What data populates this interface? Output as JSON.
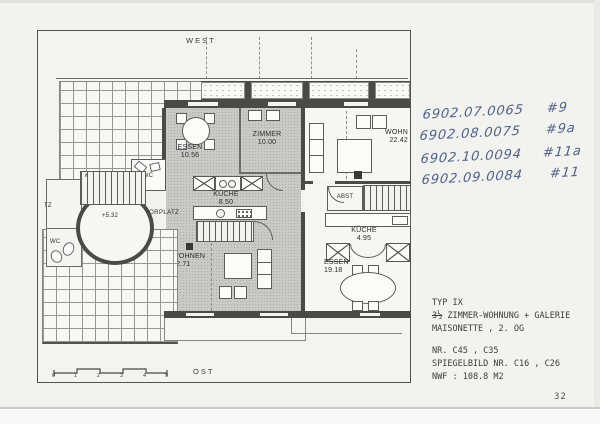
{
  "colors": {
    "paper": "#f2f2ee",
    "ink": "#3d3d3b",
    "pen_blue": "#50618d",
    "room_gray": "#c9c9c5",
    "wall_dark": "#4a4a46"
  },
  "plan": {
    "orientation_top": "WEST",
    "orientation_bottom": "OST",
    "level_mark": "+5.32",
    "rooms": {
      "essen_upper": {
        "name": "ESSEN",
        "area": "10.56"
      },
      "zimmer": {
        "name": "ZIMMER",
        "area": "10.00"
      },
      "kueche_main": {
        "name": "KÜCHE",
        "area": "8.50"
      },
      "vorplatz": {
        "name": "VORPLATZ"
      },
      "wc_inner": {
        "name": "WC"
      },
      "wc_left": {
        "name": "WC"
      },
      "tz": {
        "name": "TZ"
      },
      "wohnen": {
        "name": "WOHNEN",
        "area": "22.71"
      },
      "wohn_right": {
        "name": "WOHN",
        "area": "22.42"
      },
      "abst": {
        "name": "ABST"
      },
      "kueche_small": {
        "name": "KÜCHE",
        "area": "4.95"
      },
      "essen_lower": {
        "name": "ESSEN",
        "area": "19.18"
      }
    },
    "scale_ticks": [
      "0",
      "1",
      "2",
      "3",
      "4",
      "5"
    ]
  },
  "handwritten_notes": [
    {
      "code": "6902.07.0065",
      "tag": "#9"
    },
    {
      "code": "6902.08.0075",
      "tag": "#9a"
    },
    {
      "code": "6902.10.0094",
      "tag": "#11a"
    },
    {
      "code": "6902.09.0084",
      "tag": "#11"
    }
  ],
  "title_block": {
    "line1": "TYP IX",
    "struck": "3½",
    "line2": "ZIMMER-WOHNUNG + GALERIE",
    "line3": "MAISONETTE , 2. OG",
    "line4": "NR. C45 , C35",
    "line5": "SPIEGELBILD  NR. C16 , C26",
    "line6": "NWF : 108.8  M2"
  },
  "page_number": "32"
}
